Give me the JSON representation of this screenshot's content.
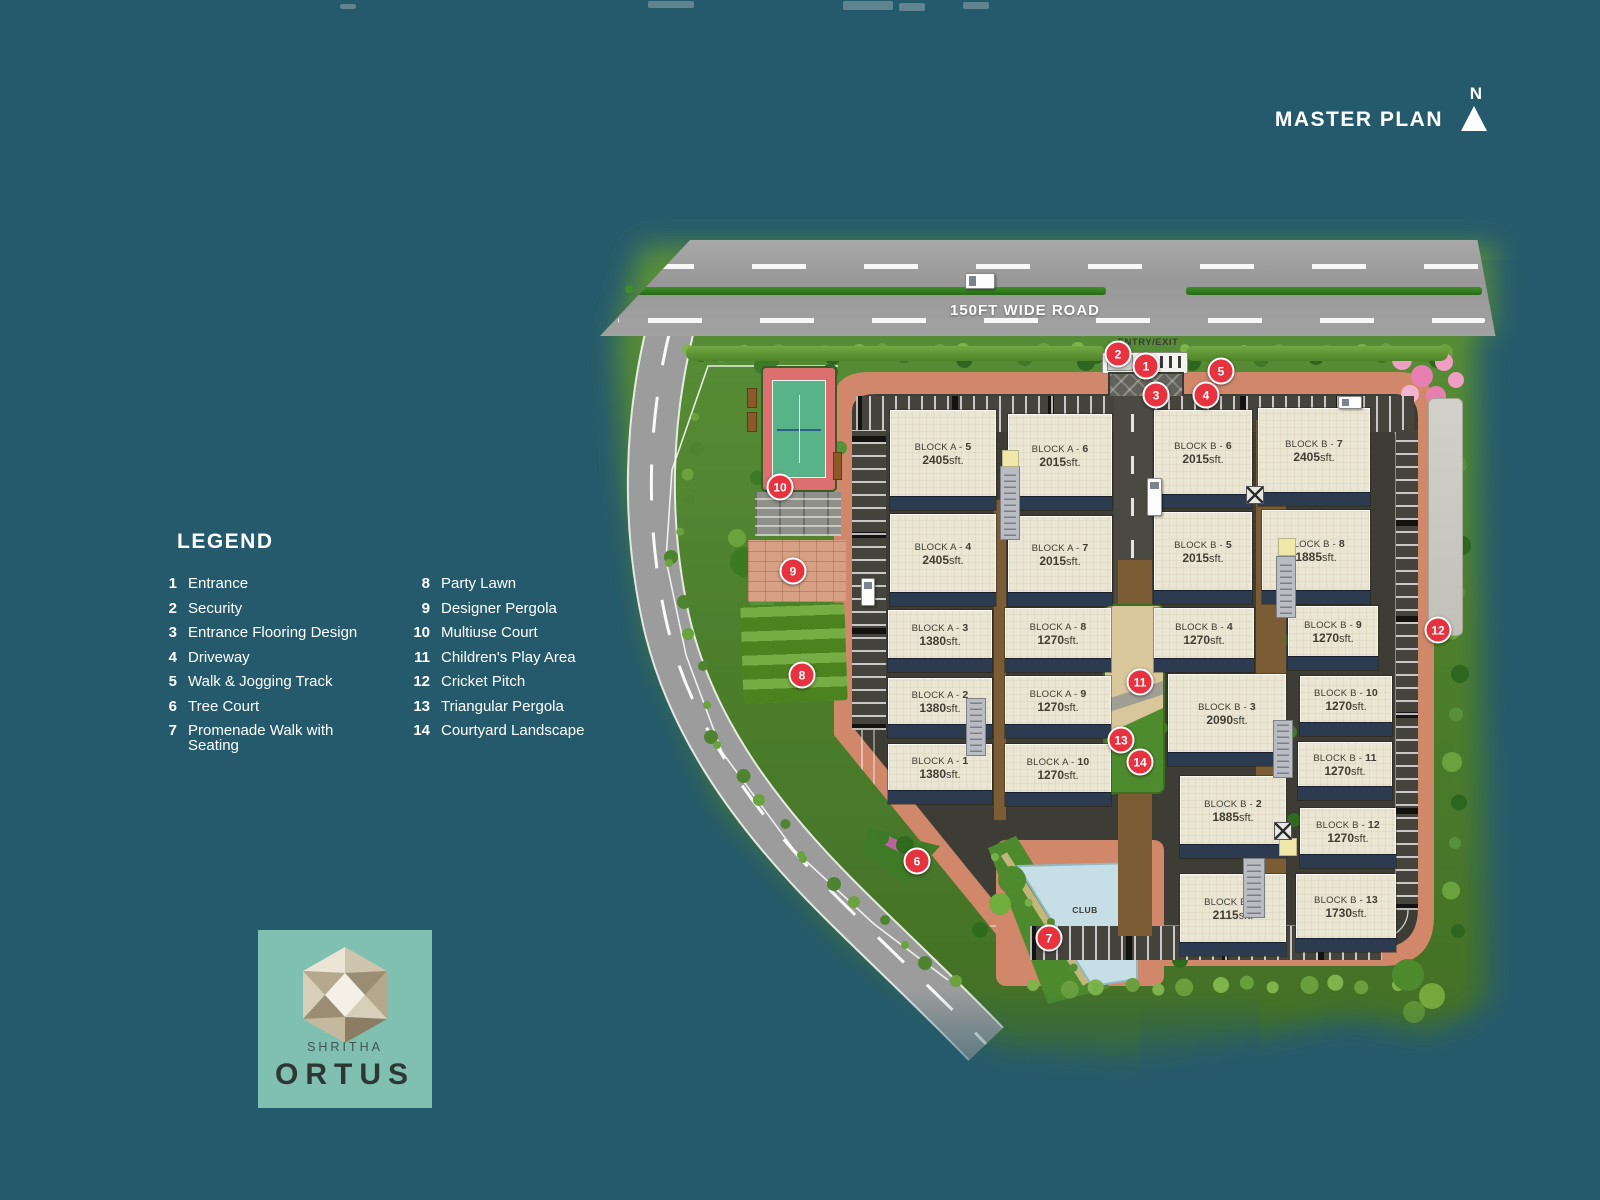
{
  "header": {
    "title": "MASTER PLAN",
    "compass_n": "N"
  },
  "road": {
    "name": "150FT WIDE ROAD",
    "entry": "ENTRY/EXIT"
  },
  "club": {
    "label": "CLUB"
  },
  "legend": {
    "title": "LEGEND",
    "items": [
      {
        "num": "1",
        "label": "Entrance"
      },
      {
        "num": "2",
        "label": "Security"
      },
      {
        "num": "3",
        "label": "Entrance Flooring Design"
      },
      {
        "num": "4",
        "label": "Driveway"
      },
      {
        "num": "5",
        "label": "Walk & Jogging Track"
      },
      {
        "num": "6",
        "label": "Tree Court"
      },
      {
        "num": "7",
        "label": "Promenade Walk with Seating"
      },
      {
        "num": "8",
        "label": "Party Lawn"
      },
      {
        "num": "9",
        "label": "Designer Pergola"
      },
      {
        "num": "10",
        "label": "Multiuse Court"
      },
      {
        "num": "11",
        "label": "Children's Play Area"
      },
      {
        "num": "12",
        "label": "Cricket Pitch"
      },
      {
        "num": "13",
        "label": "Triangular Pergola"
      },
      {
        "num": "14",
        "label": "Courtyard Landscape"
      }
    ]
  },
  "logo": {
    "brand": "SHRITHA",
    "name": "ORTUS"
  },
  "buildings": [
    {
      "prefix": "BLOCK A -",
      "num": "1",
      "area": "1380",
      "unit": "sft.",
      "x": 888,
      "y": 744,
      "w": 104,
      "h": 60
    },
    {
      "prefix": "BLOCK A -",
      "num": "2",
      "area": "1380",
      "unit": "sft.",
      "x": 888,
      "y": 678,
      "w": 104,
      "h": 60
    },
    {
      "prefix": "BLOCK A -",
      "num": "3",
      "area": "1380",
      "unit": "sft.",
      "x": 888,
      "y": 610,
      "w": 104,
      "h": 62
    },
    {
      "prefix": "BLOCK A -",
      "num": "4",
      "area": "2405",
      "unit": "sft.",
      "x": 890,
      "y": 514,
      "w": 106,
      "h": 92
    },
    {
      "prefix": "BLOCK A -",
      "num": "5",
      "area": "2405",
      "unit": "sft.",
      "x": 890,
      "y": 410,
      "w": 106,
      "h": 100
    },
    {
      "prefix": "BLOCK A -",
      "num": "6",
      "area": "2015",
      "unit": "sft.",
      "x": 1008,
      "y": 414,
      "w": 104,
      "h": 96
    },
    {
      "prefix": "BLOCK A -",
      "num": "7",
      "area": "2015",
      "unit": "sft.",
      "x": 1008,
      "y": 516,
      "w": 104,
      "h": 90
    },
    {
      "prefix": "BLOCK A -",
      "num": "8",
      "area": "1270",
      "unit": "sft.",
      "x": 1005,
      "y": 608,
      "w": 106,
      "h": 64
    },
    {
      "prefix": "BLOCK A -",
      "num": "9",
      "area": "1270",
      "unit": "sft.",
      "x": 1005,
      "y": 676,
      "w": 106,
      "h": 62
    },
    {
      "prefix": "BLOCK A -",
      "num": "10",
      "area": "1270",
      "unit": "sft.",
      "x": 1005,
      "y": 744,
      "w": 106,
      "h": 62
    },
    {
      "prefix": "BLOCK B -",
      "num": "1",
      "area": "2115",
      "unit": "sft.",
      "x": 1180,
      "y": 874,
      "w": 106,
      "h": 82
    },
    {
      "prefix": "BLOCK B -",
      "num": "2",
      "area": "1885",
      "unit": "sft.",
      "x": 1180,
      "y": 776,
      "w": 106,
      "h": 82
    },
    {
      "prefix": "BLOCK B -",
      "num": "3",
      "area": "2090",
      "unit": "sft.",
      "x": 1168,
      "y": 674,
      "w": 118,
      "h": 92
    },
    {
      "prefix": "BLOCK B -",
      "num": "4",
      "area": "1270",
      "unit": "sft.",
      "x": 1154,
      "y": 608,
      "w": 100,
      "h": 64
    },
    {
      "prefix": "BLOCK B -",
      "num": "5",
      "area": "2015",
      "unit": "sft.",
      "x": 1154,
      "y": 512,
      "w": 98,
      "h": 92
    },
    {
      "prefix": "BLOCK B -",
      "num": "6",
      "area": "2015",
      "unit": "sft.",
      "x": 1154,
      "y": 410,
      "w": 98,
      "h": 98
    },
    {
      "prefix": "BLOCK B -",
      "num": "7",
      "area": "2405",
      "unit": "sft.",
      "x": 1258,
      "y": 408,
      "w": 112,
      "h": 98
    },
    {
      "prefix": "BLOCK B -",
      "num": "8",
      "area": "1885",
      "unit": "sft.",
      "x": 1262,
      "y": 510,
      "w": 108,
      "h": 94
    },
    {
      "prefix": "BLOCK B -",
      "num": "9",
      "area": "1270",
      "unit": "sft.",
      "x": 1288,
      "y": 606,
      "w": 90,
      "h": 64
    },
    {
      "prefix": "BLOCK B -",
      "num": "10",
      "area": "1270",
      "unit": "sft.",
      "x": 1300,
      "y": 676,
      "w": 92,
      "h": 60
    },
    {
      "prefix": "BLOCK B -",
      "num": "11",
      "area": "1270",
      "unit": "sft.",
      "x": 1298,
      "y": 742,
      "w": 94,
      "h": 58
    },
    {
      "prefix": "BLOCK B -",
      "num": "12",
      "area": "1270",
      "unit": "sft.",
      "x": 1300,
      "y": 808,
      "w": 96,
      "h": 60
    },
    {
      "prefix": "BLOCK B -",
      "num": "13",
      "area": "1730",
      "unit": "sft.",
      "x": 1296,
      "y": 874,
      "w": 100,
      "h": 78
    }
  ],
  "markers": [
    {
      "num": "1",
      "x": 1146,
      "y": 366
    },
    {
      "num": "2",
      "x": 1118,
      "y": 354
    },
    {
      "num": "3",
      "x": 1156,
      "y": 395
    },
    {
      "num": "4",
      "x": 1206,
      "y": 395
    },
    {
      "num": "5",
      "x": 1221,
      "y": 371
    },
    {
      "num": "6",
      "x": 917,
      "y": 861
    },
    {
      "num": "7",
      "x": 1049,
      "y": 938
    },
    {
      "num": "8",
      "x": 802,
      "y": 675
    },
    {
      "num": "9",
      "x": 793,
      "y": 571
    },
    {
      "num": "10",
      "x": 780,
      "y": 487
    },
    {
      "num": "11",
      "x": 1140,
      "y": 682
    },
    {
      "num": "12",
      "x": 1438,
      "y": 630
    },
    {
      "num": "13",
      "x": 1121,
      "y": 740
    },
    {
      "num": "14",
      "x": 1140,
      "y": 762
    }
  ],
  "colors": {
    "background": "#255a6c",
    "marker_red": "#e6333f",
    "terracotta": "#d0876a",
    "building_cream": "#ebe5d3",
    "navy": "#2d3b50",
    "grass": "#56862f",
    "road_grey": "#9c9c9c",
    "court_red": "#dd6f6f",
    "court_green": "#58b488",
    "pool_blue": "#c6dfe7",
    "logo_bg": "#7fc0b1",
    "corridor_brown": "#7b5c35"
  }
}
